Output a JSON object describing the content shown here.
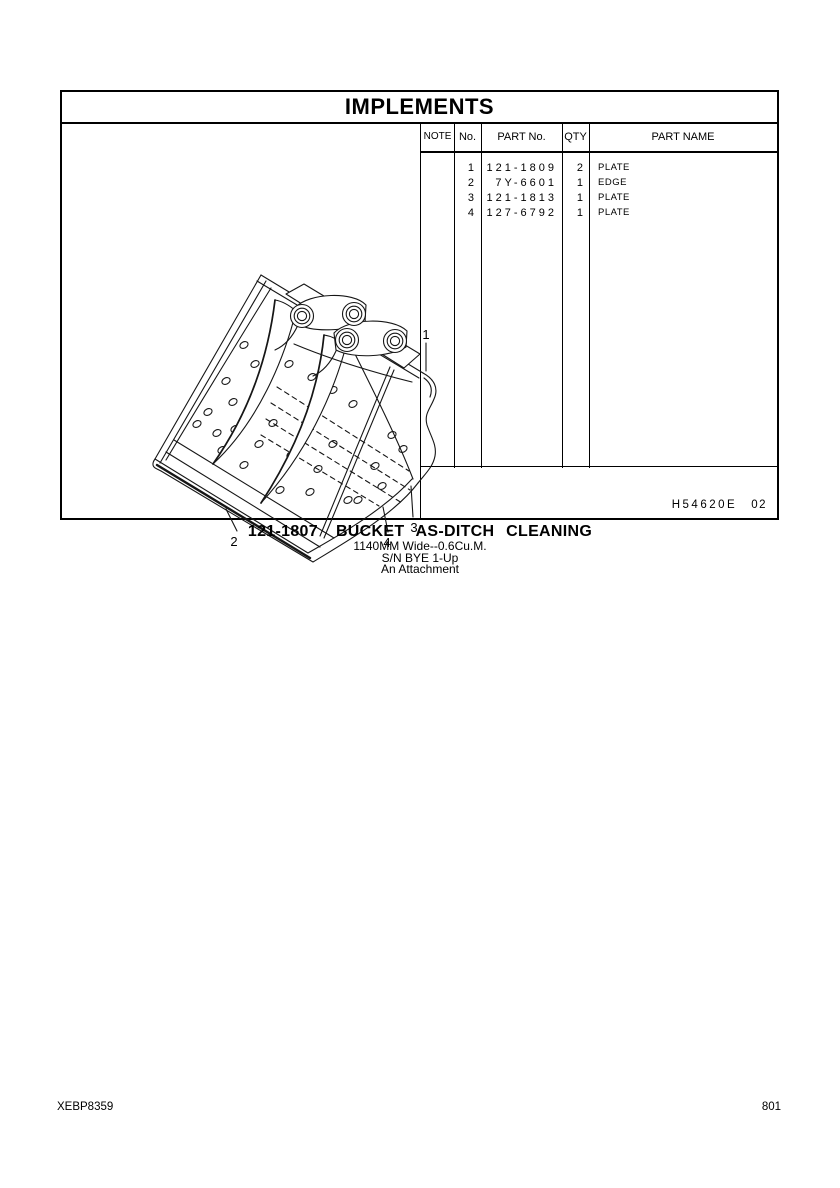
{
  "page": {
    "paper_color": "#ffffff",
    "ink_color": "#000000"
  },
  "header": {
    "title": "IMPLEMENTS"
  },
  "parts_table": {
    "columns": [
      "NOTE",
      "No.",
      "PART No.",
      "QTY",
      "PART NAME"
    ],
    "rows": [
      {
        "note": "",
        "no": "1",
        "part_no": "121-1809",
        "qty": "2",
        "part_name": "PLATE"
      },
      {
        "note": "",
        "no": "2",
        "part_no": "7Y-6601",
        "qty": "1",
        "part_name": "EDGE"
      },
      {
        "note": "",
        "no": "3",
        "part_no": "121-1813",
        "qty": "1",
        "part_name": "PLATE"
      },
      {
        "note": "",
        "no": "4",
        "part_no": "127-6792",
        "qty": "1",
        "part_name": "PLATE"
      }
    ],
    "drawing_number": "H54620E",
    "revision": "02"
  },
  "figure": {
    "description": "Isometric line drawing of a ditch-cleaning bucket with mounting lugs, rib plates, drain holes and hidden-edge dashed lines",
    "callouts": [
      {
        "label": "1"
      },
      {
        "label": "2"
      },
      {
        "label": "3"
      },
      {
        "label": "4"
      }
    ]
  },
  "caption": {
    "part_number": "121-1807",
    "title": "BUCKET AS-DITCH CLEANING",
    "size_line": "1140MM Wide--0.6Cu.M.",
    "serial_line": "S/N BYE 1-Up",
    "attachment_line": "An Attachment"
  },
  "page_footer": {
    "document_code": "XEBP8359",
    "page_number": "801"
  }
}
